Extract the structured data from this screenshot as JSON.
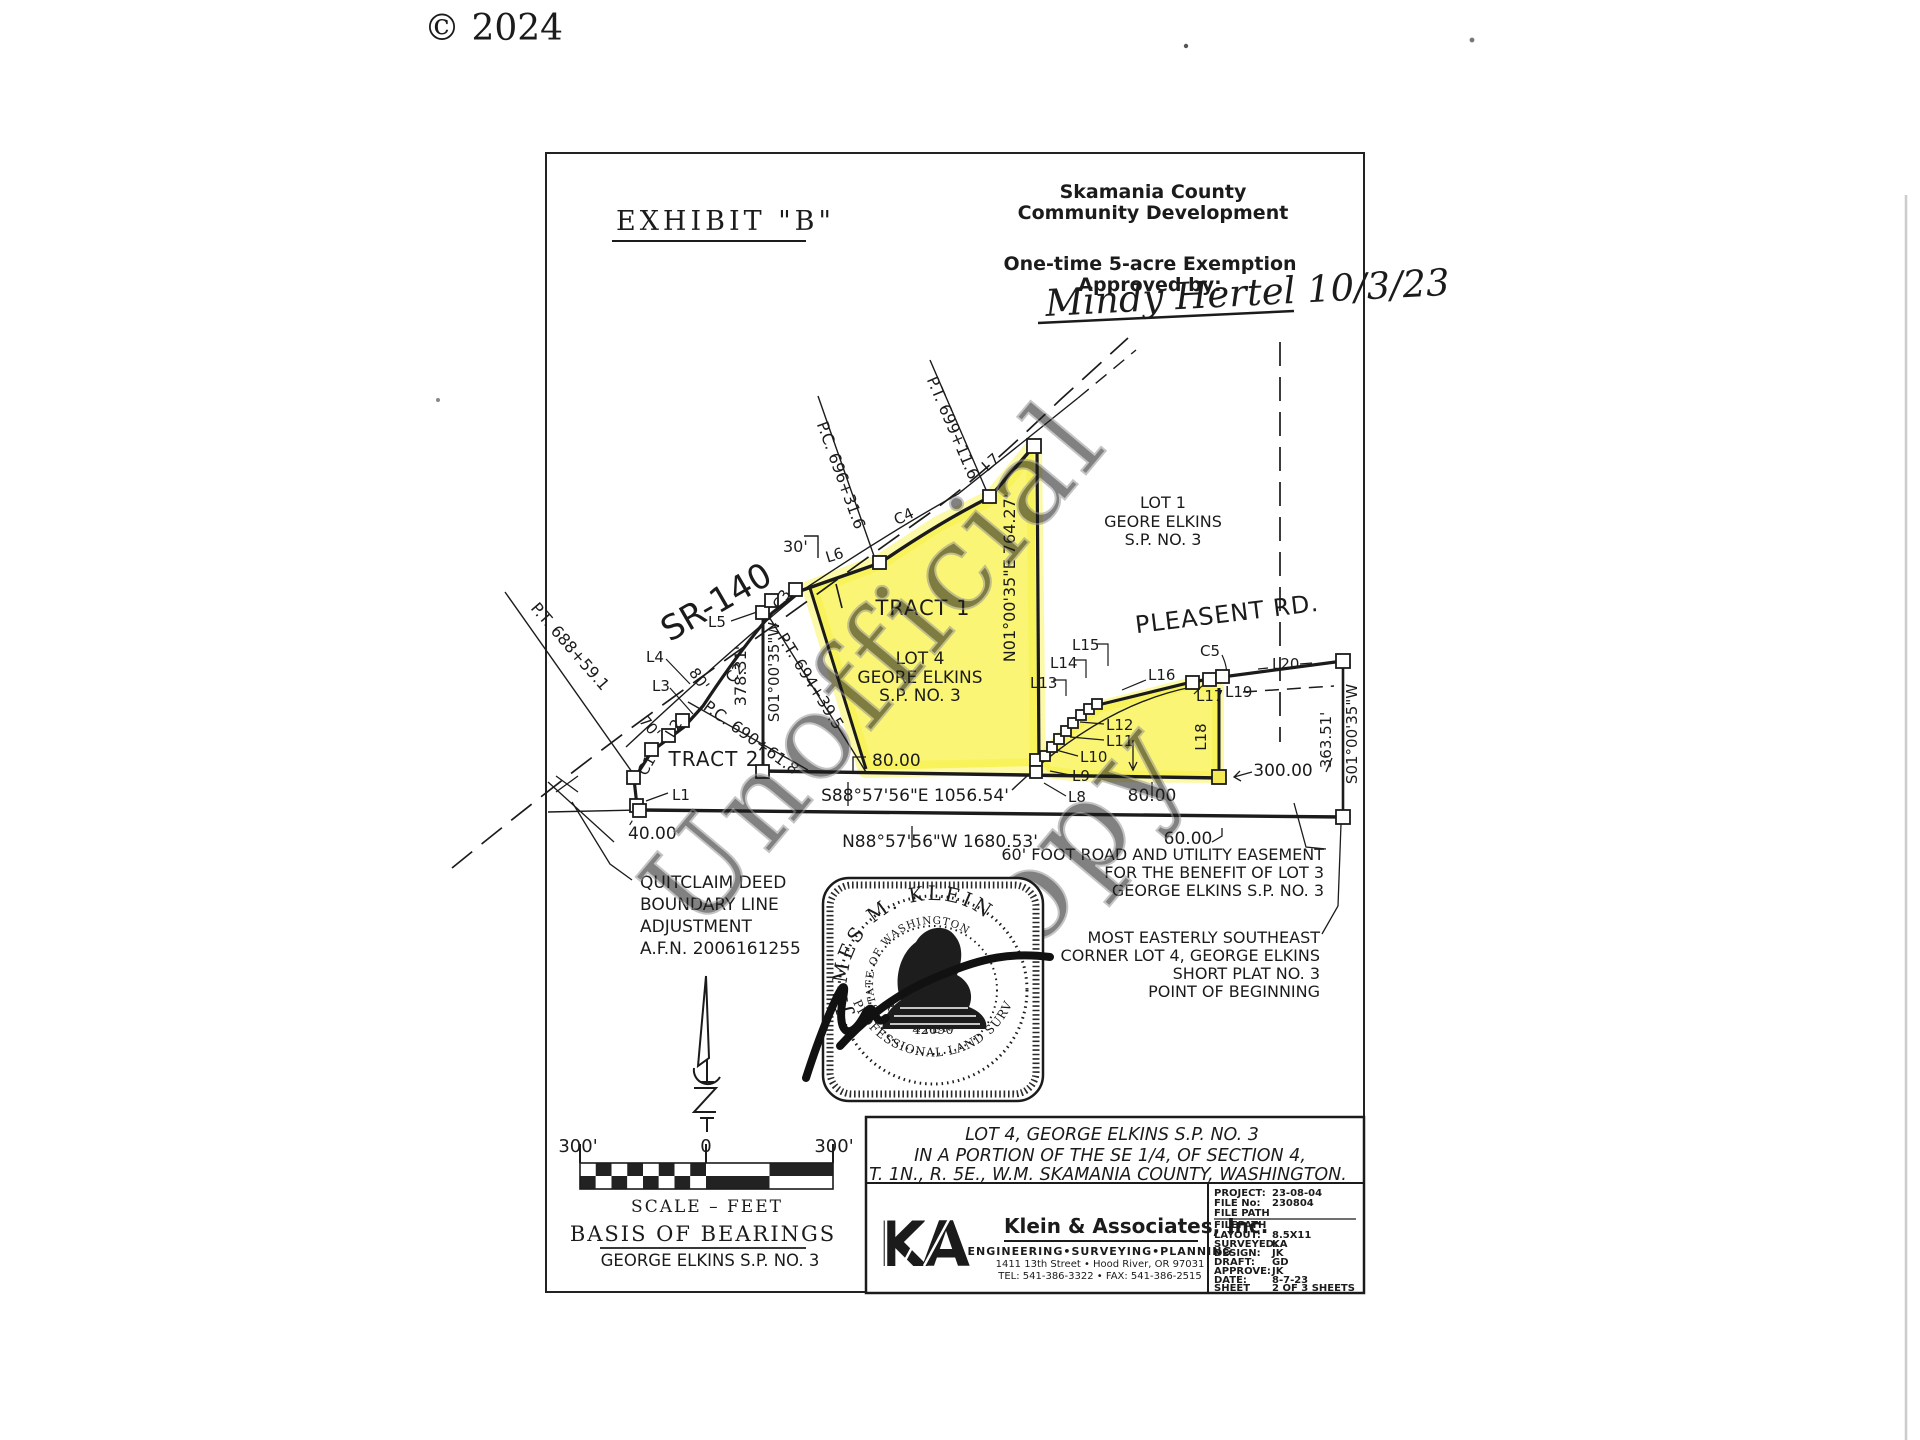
{
  "page": {
    "copyright": "© 2024"
  },
  "header": {
    "exhibit": "EXHIBIT \"B\"",
    "dept1": "Skamania County",
    "dept2": "Community Development",
    "exemption": "One-time 5-acre Exemption",
    "approved_by": "Approved by:",
    "approval_signature": "Mindy Hertel 10/3/23"
  },
  "watermark": {
    "word1": "Unofficial",
    "word2": "Copy"
  },
  "map": {
    "highway": "SR-140",
    "road": "PLEASENT RD.",
    "tract1": "TRACT 1",
    "tract2": "TRACT 2",
    "lot4": [
      "LOT 4",
      "GEORE ELKINS",
      "S.P. NO. 3"
    ],
    "lot1": [
      "LOT 1",
      "GEORE ELKINS",
      "S.P. NO. 3"
    ],
    "stations": {
      "pc696": "P.C. 696+31.6",
      "pt699": "P.T. 699+11.6",
      "pt688": "P.T. 688+59.1",
      "pc690": "P.C. 690+61.8",
      "pt694": "P.T. 694+39.5"
    },
    "bearings": {
      "east_line": "N01°00'35\"E 764.27'",
      "west_line": "S01°00'35\"W",
      "west_dist": "378.31'",
      "south_upper": "S88°57'56\"E 1056.54'",
      "south_lower": "N88°57'56\"W 1680.53'",
      "right_line": "S01°00'35\"W",
      "right_dist": "363.51'"
    },
    "dims": {
      "d30": "30'",
      "d70": "70'",
      "d80r": "80'",
      "d40": "40.00",
      "d80a": "80.00",
      "d80b": "80.00",
      "d60": "60.00",
      "d300": "300.00"
    },
    "lines": {
      "l1": "L1",
      "l2": "L2",
      "l3": "L3",
      "l4": "L4",
      "l5": "L5",
      "l6": "L6",
      "l7": "L7",
      "l8": "L8",
      "l9": "L9",
      "l10": "L10",
      "l11": "L11",
      "l12": "L12",
      "l13": "L13",
      "l14": "L14",
      "l15": "L15",
      "l16": "L16",
      "l17": "L17",
      "l18": "L18",
      "l19": "L19",
      "l20": "L20",
      "c1": "C1",
      "c2": "C2",
      "c3": "C3",
      "c4": "C4",
      "c5": "C5"
    },
    "notes": {
      "quitclaim": [
        "QUITCLAIM DEED",
        "BOUNDARY LINE",
        "ADJUSTMENT",
        "A.F.N. 2006161255"
      ],
      "easement": [
        "60' FOOT ROAD AND UTILITY EASEMENT",
        "FOR THE BENEFIT OF LOT 3",
        "GEORGE ELKINS S.P. NO. 3"
      ],
      "pob": [
        "MOST EASTERLY SOUTHEAST",
        "CORNER LOT 4, GEORGE ELKINS",
        "SHORT PLAT NO. 3",
        "POINT OF BEGINNING"
      ]
    }
  },
  "seal": {
    "name": "JAMES M. KLEIN",
    "state": "STATE OF WASHINGTON",
    "number": "42690",
    "registered": "REGISTERED",
    "profession": "PROFESSIONAL LAND SURVEYOR"
  },
  "scalebar": {
    "left": "300'",
    "zero": "0",
    "right": "300'",
    "caption": "SCALE – FEET",
    "basis_title": "BASIS OF BEARINGS",
    "basis_value": "GEORGE ELKINS S.P. NO. 3"
  },
  "titleblock": {
    "desc": [
      "LOT 4, GEORGE ELKINS S.P. NO. 3",
      "IN A PORTION OF THE SE 1/4, OF SECTION 4,",
      "T. 1N., R. 5E., W.M. SKAMANIA COUNTY, WASHINGTON."
    ],
    "firm": {
      "logo": "KA",
      "name": "Klein & Associates, Inc.",
      "services": "ENGINEERING•SURVEYING•PLANNING",
      "address": "1411 13th Street • Hood River, OR 97031",
      "phone": "TEL: 541-386-3322 • FAX: 541-386-2515"
    },
    "info": [
      {
        "label": "PROJECT:",
        "value": "23-08-04"
      },
      {
        "label": "FILE No:",
        "value": "230804"
      },
      {
        "label": "FILE PATH",
        "value": ""
      },
      {
        "label": "FILEPATH",
        "value": ""
      },
      {
        "label": "LAYOUT:",
        "value": "8.5X11"
      },
      {
        "label": "SURVEYED:",
        "value": "KA"
      },
      {
        "label": "DESIGN:",
        "value": "JK"
      },
      {
        "label": "DRAFT:",
        "value": "GD"
      },
      {
        "label": "APPROVE:",
        "value": "JK"
      },
      {
        "label": "DATE:",
        "value": "8-7-23"
      },
      {
        "label": "SHEET",
        "value": "2 OF 3 SHEETS"
      }
    ]
  }
}
